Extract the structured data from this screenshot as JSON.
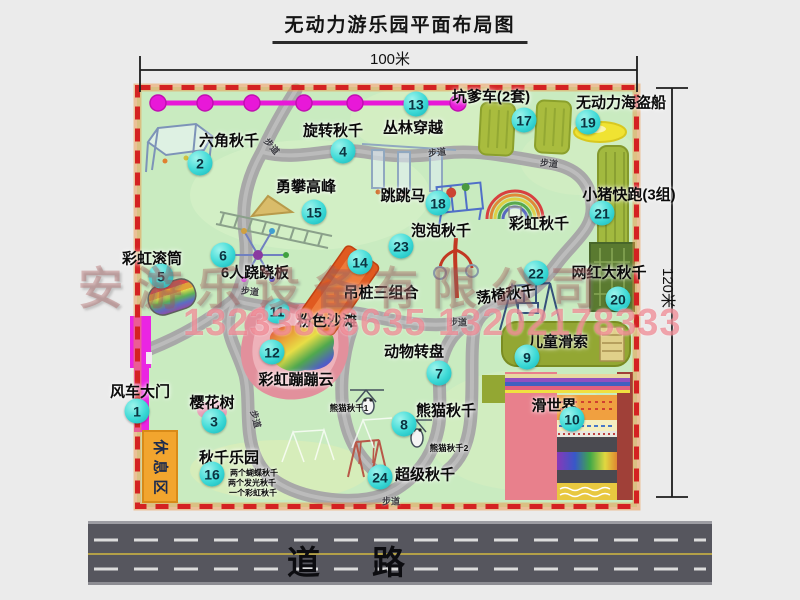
{
  "title": "无动力游乐园平面布局图",
  "dimensions": {
    "top": "100米",
    "right": "120米"
  },
  "road": {
    "label": "道路"
  },
  "watermark": {
    "company": "安游乐设备有限公司",
    "phone": "13233836635 13202178333"
  },
  "trail_text": "步道",
  "rest_area": {
    "text": "休息区"
  },
  "colors": {
    "map_green": "#c9ebc0",
    "border_red": "#d42222",
    "marker_teal": "#2ed3d3",
    "gate_magenta": "#ea25e2",
    "zipline_magenta": "#e818d8",
    "road_gray": "#56565e"
  },
  "markers": [
    {
      "num": "1",
      "label_text": "风车大门",
      "marker": [
        137,
        411
      ],
      "label": [
        140,
        391
      ]
    },
    {
      "num": "2",
      "label_text": "六角秋千",
      "marker": [
        200,
        163
      ],
      "label": [
        229,
        140
      ]
    },
    {
      "num": "3",
      "label_text": "樱花树",
      "marker": [
        214,
        421
      ],
      "label": [
        212,
        402
      ]
    },
    {
      "num": "4",
      "label_text": "旋转秋千",
      "marker": [
        343,
        151
      ],
      "label": [
        333,
        130
      ]
    },
    {
      "num": "5",
      "label_text": "彩虹滚筒",
      "marker": [
        161,
        276
      ],
      "label": [
        152,
        258
      ]
    },
    {
      "num": "6",
      "label_text": "6人跷跷板",
      "marker": [
        223,
        255
      ],
      "label": [
        255,
        272
      ]
    },
    {
      "num": "7",
      "label_text": "动物转盘",
      "marker": [
        439,
        373
      ],
      "label": [
        414,
        351
      ]
    },
    {
      "num": "8",
      "label_text": "熊猫秋千",
      "marker": [
        404,
        424
      ],
      "label": [
        446,
        410
      ]
    },
    {
      "num": "9",
      "label_text": "儿童滑索",
      "marker": [
        527,
        357
      ],
      "label": [
        558,
        341
      ]
    },
    {
      "num": "10",
      "label_text": "滑世界",
      "marker": [
        572,
        419
      ],
      "label": [
        554,
        405
      ]
    },
    {
      "num": "11",
      "label_text": "粉色沙滩",
      "marker": [
        277,
        311
      ],
      "label": [
        327,
        320
      ]
    },
    {
      "num": "12",
      "label_text": "彩虹蹦蹦云",
      "marker": [
        272,
        352
      ],
      "label": [
        296,
        379
      ]
    },
    {
      "num": "13",
      "label_text": "丛林穿越",
      "marker": [
        416,
        104
      ],
      "label": [
        413,
        127
      ]
    },
    {
      "num": "14",
      "label_text": "吊桩三组合",
      "marker": [
        360,
        262
      ],
      "label": [
        381,
        292
      ]
    },
    {
      "num": "15",
      "label_text": "勇攀高峰",
      "marker": [
        314,
        212
      ],
      "label": [
        306,
        186
      ]
    },
    {
      "num": "16",
      "label_text": "秋千乐园",
      "marker": [
        212,
        474
      ],
      "label": [
        229,
        457
      ]
    },
    {
      "num": "17",
      "label_text": "坑爹车(2套)",
      "marker": [
        524,
        120
      ],
      "label": [
        491,
        96
      ]
    },
    {
      "num": "18",
      "label_text": "跳跳马",
      "marker": [
        438,
        203
      ],
      "label": [
        403,
        195
      ]
    },
    {
      "num": "19",
      "label_text": "无动力海盗船",
      "marker": [
        588,
        122
      ],
      "label": [
        621,
        102
      ]
    },
    {
      "num": "20",
      "label_text": "网红大秋千",
      "marker": [
        618,
        299
      ],
      "label": [
        609,
        272
      ]
    },
    {
      "num": "21",
      "label_text": "小猪快跑(3组)",
      "marker": [
        602,
        213
      ],
      "label": [
        629,
        194
      ]
    },
    {
      "num": "22",
      "label_text": "荡椅秋千",
      "marker": [
        536,
        273
      ],
      "label": [
        506,
        294
      ],
      "rot": -8
    },
    {
      "num": "23",
      "label_text": "泡泡秋千",
      "marker": [
        401,
        246
      ],
      "label": [
        441,
        230
      ]
    },
    {
      "num": "24",
      "label_text": "超级秋千",
      "marker": [
        380,
        477
      ],
      "label": [
        425,
        474
      ]
    }
  ],
  "sub_labels": [
    {
      "text": "彩虹秋千",
      "x": 539,
      "y": 223,
      "size": 15
    },
    {
      "text": "熊猫秋千1",
      "x": 349,
      "y": 408,
      "size": 8.5
    },
    {
      "text": "熊猫秋千2",
      "x": 449,
      "y": 448,
      "size": 8.5
    },
    {
      "text": "两个蝴蝶秋千",
      "x": 254,
      "y": 473,
      "size": 8
    },
    {
      "text": "两个发光秋千",
      "x": 252,
      "y": 483,
      "size": 8
    },
    {
      "text": "一个彩虹秋千",
      "x": 253,
      "y": 493,
      "size": 8
    }
  ],
  "trail_labels": [
    {
      "x": 272,
      "y": 146,
      "rot": 50
    },
    {
      "x": 437,
      "y": 152,
      "rot": -6
    },
    {
      "x": 549,
      "y": 163,
      "rot": 6
    },
    {
      "x": 250,
      "y": 291,
      "rot": 6
    },
    {
      "x": 458,
      "y": 322,
      "rot": 0
    },
    {
      "x": 256,
      "y": 419,
      "rot": 75
    },
    {
      "x": 391,
      "y": 501,
      "rot": 0
    }
  ]
}
